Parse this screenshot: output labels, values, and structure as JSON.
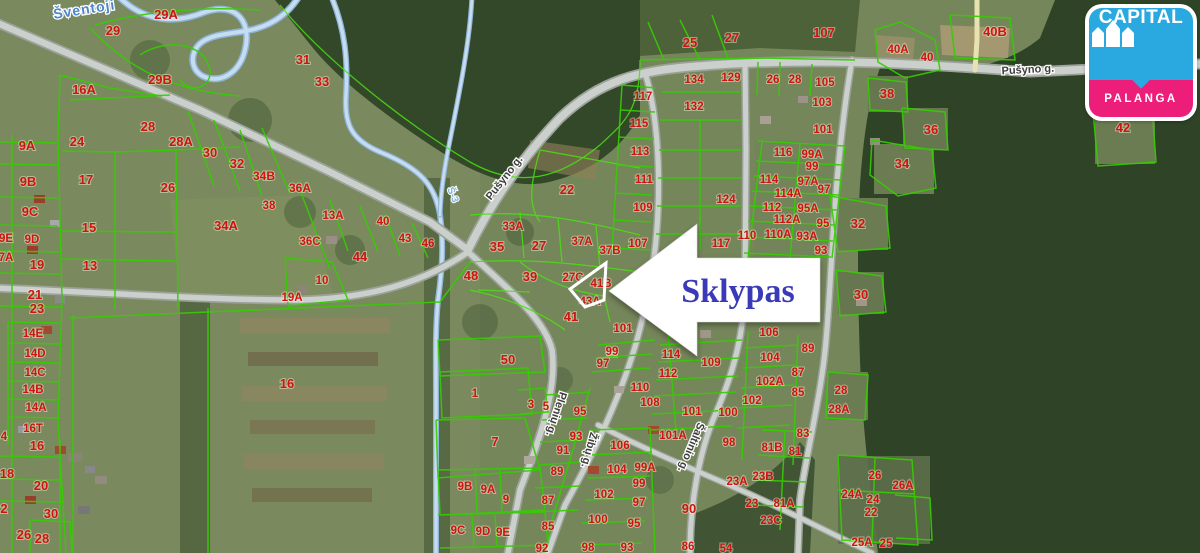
{
  "logo": {
    "brand": "CAPITAL",
    "location": "PALANGA",
    "blue": "#2aa9e0",
    "pink": "#ed1e79"
  },
  "callout": {
    "label": "Sklypas",
    "color": "#3a3ab8"
  },
  "map": {
    "colors": {
      "parcel_line": "#35cc02",
      "parcel_label": "#ce1410",
      "road": "#c9cdc9",
      "river": "#bcd6ee",
      "forest": "#31452a",
      "field": "#75855a"
    },
    "river_labels": [
      {
        "t": "Šventoji",
        "x": 85,
        "y": 14,
        "rot": -9,
        "small": false
      },
      {
        "t": "Š-3",
        "x": 450,
        "y": 196,
        "rot": 68,
        "small": true
      }
    ],
    "street_labels": [
      {
        "t": "Pušyno g.",
        "x": 507,
        "y": 180,
        "rot": -52
      },
      {
        "t": "Pušyno g.",
        "x": 1028,
        "y": 73,
        "rot": -3
      },
      {
        "t": "Plenių g.",
        "x": 553,
        "y": 413,
        "rot": 108
      },
      {
        "t": "Žibų g.",
        "x": 586,
        "y": 449,
        "rot": 105
      },
      {
        "t": "Šaltinio g.",
        "x": 688,
        "y": 446,
        "rot": 113
      }
    ],
    "parcel_labels": [
      {
        "t": "29",
        "x": 113,
        "y": 35,
        "s": 13
      },
      {
        "t": "29A",
        "x": 166,
        "y": 19,
        "s": 13
      },
      {
        "t": "29B",
        "x": 160,
        "y": 84,
        "s": 13
      },
      {
        "t": "16A",
        "x": 84,
        "y": 94,
        "s": 13
      },
      {
        "t": "31",
        "x": 303,
        "y": 64,
        "s": 13
      },
      {
        "t": "33",
        "x": 322,
        "y": 86,
        "s": 13
      },
      {
        "t": "28",
        "x": 148,
        "y": 131,
        "s": 13
      },
      {
        "t": "28A",
        "x": 181,
        "y": 146,
        "s": 13
      },
      {
        "t": "30",
        "x": 210,
        "y": 157,
        "s": 13
      },
      {
        "t": "32",
        "x": 237,
        "y": 168,
        "s": 13
      },
      {
        "t": "34B",
        "x": 264,
        "y": 180,
        "s": 12
      },
      {
        "t": "36A",
        "x": 300,
        "y": 192,
        "s": 12
      },
      {
        "t": "9A",
        "x": 27,
        "y": 150,
        "s": 13
      },
      {
        "t": "24",
        "x": 77,
        "y": 146,
        "s": 13
      },
      {
        "t": "17",
        "x": 86,
        "y": 184,
        "s": 13
      },
      {
        "t": "9B",
        "x": 28,
        "y": 186,
        "s": 13
      },
      {
        "t": "26",
        "x": 168,
        "y": 192,
        "s": 13
      },
      {
        "t": "9C",
        "x": 30,
        "y": 216,
        "s": 13
      },
      {
        "t": "15",
        "x": 89,
        "y": 232,
        "s": 13
      },
      {
        "t": "34A",
        "x": 226,
        "y": 230,
        "s": 13
      },
      {
        "t": "38",
        "x": 269,
        "y": 209
      },
      {
        "t": "13A",
        "x": 333,
        "y": 219
      },
      {
        "t": "40",
        "x": 383,
        "y": 225
      },
      {
        "t": "43",
        "x": 405,
        "y": 242
      },
      {
        "t": "46",
        "x": 428,
        "y": 247
      },
      {
        "t": "44",
        "x": 360,
        "y": 261,
        "s": 13
      },
      {
        "t": "36C",
        "x": 310,
        "y": 245
      },
      {
        "t": "9E",
        "x": 6,
        "y": 242
      },
      {
        "t": "9D",
        "x": 32,
        "y": 243
      },
      {
        "t": "7A",
        "x": 6,
        "y": 261
      },
      {
        "t": "19",
        "x": 37,
        "y": 269,
        "s": 13
      },
      {
        "t": "13",
        "x": 90,
        "y": 270,
        "s": 13
      },
      {
        "t": "19A",
        "x": 292,
        "y": 301
      },
      {
        "t": "10",
        "x": 322,
        "y": 284
      },
      {
        "t": "21",
        "x": 35,
        "y": 299,
        "s": 13
      },
      {
        "t": "23",
        "x": 37,
        "y": 313,
        "s": 13
      },
      {
        "t": "14E",
        "x": 33,
        "y": 337
      },
      {
        "t": "14D",
        "x": 35,
        "y": 357
      },
      {
        "t": "14C",
        "x": 35,
        "y": 376
      },
      {
        "t": "14B",
        "x": 33,
        "y": 393
      },
      {
        "t": "14A",
        "x": 36,
        "y": 411
      },
      {
        "t": "16T",
        "x": 33,
        "y": 432
      },
      {
        "t": "16",
        "x": 37,
        "y": 450,
        "s": 13
      },
      {
        "t": "4",
        "x": 4,
        "y": 440
      },
      {
        "t": "18",
        "x": 7,
        "y": 478,
        "s": 13
      },
      {
        "t": "20",
        "x": 41,
        "y": 490,
        "s": 13
      },
      {
        "t": "2",
        "x": 4,
        "y": 513,
        "s": 13
      },
      {
        "t": "30",
        "x": 51,
        "y": 518,
        "s": 13
      },
      {
        "t": "26",
        "x": 24,
        "y": 539,
        "s": 13
      },
      {
        "t": "28",
        "x": 42,
        "y": 543,
        "s": 13
      },
      {
        "t": "16",
        "x": 287,
        "y": 388,
        "s": 13
      },
      {
        "t": "50",
        "x": 508,
        "y": 364,
        "s": 13
      },
      {
        "t": "1",
        "x": 475,
        "y": 397
      },
      {
        "t": "3",
        "x": 531,
        "y": 408
      },
      {
        "t": "5",
        "x": 546,
        "y": 410
      },
      {
        "t": "7",
        "x": 495,
        "y": 446,
        "s": 13
      },
      {
        "t": "48",
        "x": 471,
        "y": 280,
        "s": 13
      },
      {
        "t": "35",
        "x": 497,
        "y": 251,
        "s": 13
      },
      {
        "t": "33A",
        "x": 513,
        "y": 230
      },
      {
        "t": "27",
        "x": 539,
        "y": 250,
        "s": 13
      },
      {
        "t": "22",
        "x": 567,
        "y": 194,
        "s": 13
      },
      {
        "t": "37A",
        "x": 582,
        "y": 245
      },
      {
        "t": "37B",
        "x": 610,
        "y": 254
      },
      {
        "t": "27C",
        "x": 573,
        "y": 281
      },
      {
        "t": "39",
        "x": 530,
        "y": 281,
        "s": 13
      },
      {
        "t": "41B",
        "x": 601,
        "y": 287
      },
      {
        "t": "43A",
        "x": 590,
        "y": 305
      },
      {
        "t": "41",
        "x": 571,
        "y": 321,
        "s": 13
      },
      {
        "t": "25",
        "x": 690,
        "y": 47,
        "s": 13
      },
      {
        "t": "27",
        "x": 732,
        "y": 42,
        "s": 13
      },
      {
        "t": "107",
        "x": 824,
        "y": 37,
        "s": 13
      },
      {
        "t": "134",
        "x": 694,
        "y": 83
      },
      {
        "t": "129",
        "x": 731,
        "y": 81
      },
      {
        "t": "26",
        "x": 773,
        "y": 83
      },
      {
        "t": "28",
        "x": 795,
        "y": 83
      },
      {
        "t": "105",
        "x": 825,
        "y": 86
      },
      {
        "t": "117",
        "x": 643,
        "y": 100
      },
      {
        "t": "132",
        "x": 694,
        "y": 110
      },
      {
        "t": "115",
        "x": 639,
        "y": 127
      },
      {
        "t": "113",
        "x": 640,
        "y": 155
      },
      {
        "t": "111",
        "x": 644,
        "y": 183
      },
      {
        "t": "109",
        "x": 643,
        "y": 211
      },
      {
        "t": "107",
        "x": 638,
        "y": 247
      },
      {
        "t": "124",
        "x": 726,
        "y": 203
      },
      {
        "t": "117",
        "x": 721,
        "y": 247
      },
      {
        "t": "103",
        "x": 822,
        "y": 106
      },
      {
        "t": "101",
        "x": 823,
        "y": 133
      },
      {
        "t": "116",
        "x": 783,
        "y": 156
      },
      {
        "t": "99A",
        "x": 812,
        "y": 158
      },
      {
        "t": "99",
        "x": 812,
        "y": 170
      },
      {
        "t": "114",
        "x": 769,
        "y": 183
      },
      {
        "t": "97A",
        "x": 808,
        "y": 185
      },
      {
        "t": "97",
        "x": 824,
        "y": 193
      },
      {
        "t": "114A",
        "x": 788,
        "y": 197
      },
      {
        "t": "112",
        "x": 772,
        "y": 211
      },
      {
        "t": "95A",
        "x": 808,
        "y": 212
      },
      {
        "t": "112A",
        "x": 787,
        "y": 223
      },
      {
        "t": "95",
        "x": 823,
        "y": 227
      },
      {
        "t": "110",
        "x": 747,
        "y": 239
      },
      {
        "t": "110A",
        "x": 778,
        "y": 238
      },
      {
        "t": "93A",
        "x": 807,
        "y": 240
      },
      {
        "t": "93",
        "x": 821,
        "y": 254
      },
      {
        "t": "40A",
        "x": 898,
        "y": 53
      },
      {
        "t": "40",
        "x": 927,
        "y": 61
      },
      {
        "t": "40B",
        "x": 995,
        "y": 36,
        "s": 13
      },
      {
        "t": "38",
        "x": 887,
        "y": 98,
        "s": 13
      },
      {
        "t": "36",
        "x": 931,
        "y": 134,
        "s": 13
      },
      {
        "t": "34",
        "x": 902,
        "y": 168,
        "s": 13
      },
      {
        "t": "32",
        "x": 858,
        "y": 228,
        "s": 13
      },
      {
        "t": "42",
        "x": 1123,
        "y": 132,
        "s": 13
      },
      {
        "t": "30",
        "x": 861,
        "y": 299,
        "s": 13
      },
      {
        "t": "101",
        "x": 623,
        "y": 332
      },
      {
        "t": "99",
        "x": 612,
        "y": 355
      },
      {
        "t": "97",
        "x": 603,
        "y": 367
      },
      {
        "t": "95",
        "x": 580,
        "y": 415
      },
      {
        "t": "93",
        "x": 576,
        "y": 440
      },
      {
        "t": "91",
        "x": 563,
        "y": 454
      },
      {
        "t": "89",
        "x": 557,
        "y": 475
      },
      {
        "t": "87",
        "x": 548,
        "y": 504
      },
      {
        "t": "85",
        "x": 548,
        "y": 530
      },
      {
        "t": "9B",
        "x": 465,
        "y": 490
      },
      {
        "t": "9A",
        "x": 488,
        "y": 493
      },
      {
        "t": "9",
        "x": 506,
        "y": 503
      },
      {
        "t": "9C",
        "x": 458,
        "y": 534
      },
      {
        "t": "9D",
        "x": 483,
        "y": 535
      },
      {
        "t": "9E",
        "x": 503,
        "y": 536
      },
      {
        "t": "92",
        "x": 542,
        "y": 552
      },
      {
        "t": "98",
        "x": 588,
        "y": 551
      },
      {
        "t": "93",
        "x": 627,
        "y": 551
      },
      {
        "t": "114",
        "x": 671,
        "y": 358
      },
      {
        "t": "112",
        "x": 668,
        "y": 377
      },
      {
        "t": "110",
        "x": 640,
        "y": 391
      },
      {
        "t": "108",
        "x": 650,
        "y": 406
      },
      {
        "t": "101",
        "x": 692,
        "y": 415
      },
      {
        "t": "101A",
        "x": 673,
        "y": 439
      },
      {
        "t": "106",
        "x": 620,
        "y": 449
      },
      {
        "t": "104",
        "x": 617,
        "y": 473
      },
      {
        "t": "99A",
        "x": 645,
        "y": 471
      },
      {
        "t": "99",
        "x": 639,
        "y": 487
      },
      {
        "t": "102",
        "x": 604,
        "y": 498
      },
      {
        "t": "97",
        "x": 639,
        "y": 506
      },
      {
        "t": "100",
        "x": 598,
        "y": 523
      },
      {
        "t": "95",
        "x": 634,
        "y": 527
      },
      {
        "t": "109",
        "x": 711,
        "y": 366
      },
      {
        "t": "106",
        "x": 769,
        "y": 336
      },
      {
        "t": "104",
        "x": 770,
        "y": 361
      },
      {
        "t": "102A",
        "x": 770,
        "y": 385
      },
      {
        "t": "102",
        "x": 752,
        "y": 404
      },
      {
        "t": "100",
        "x": 728,
        "y": 416
      },
      {
        "t": "98",
        "x": 729,
        "y": 446
      },
      {
        "t": "89",
        "x": 808,
        "y": 352
      },
      {
        "t": "87",
        "x": 798,
        "y": 376
      },
      {
        "t": "85",
        "x": 798,
        "y": 396
      },
      {
        "t": "83",
        "x": 803,
        "y": 437
      },
      {
        "t": "81B",
        "x": 772,
        "y": 451
      },
      {
        "t": "81",
        "x": 795,
        "y": 455
      },
      {
        "t": "81A",
        "x": 784,
        "y": 507
      },
      {
        "t": "23A",
        "x": 737,
        "y": 485
      },
      {
        "t": "23B",
        "x": 763,
        "y": 480
      },
      {
        "t": "23",
        "x": 752,
        "y": 507
      },
      {
        "t": "23C",
        "x": 771,
        "y": 524
      },
      {
        "t": "90",
        "x": 689,
        "y": 513,
        "s": 13
      },
      {
        "t": "86",
        "x": 688,
        "y": 550
      },
      {
        "t": "54",
        "x": 726,
        "y": 552
      },
      {
        "t": "28",
        "x": 841,
        "y": 394
      },
      {
        "t": "28A",
        "x": 839,
        "y": 413
      },
      {
        "t": "26",
        "x": 875,
        "y": 479
      },
      {
        "t": "26A",
        "x": 903,
        "y": 489
      },
      {
        "t": "24A",
        "x": 852,
        "y": 498
      },
      {
        "t": "24",
        "x": 873,
        "y": 503
      },
      {
        "t": "22",
        "x": 871,
        "y": 516
      },
      {
        "t": "25A",
        "x": 862,
        "y": 546
      },
      {
        "t": "25",
        "x": 886,
        "y": 547
      }
    ]
  }
}
